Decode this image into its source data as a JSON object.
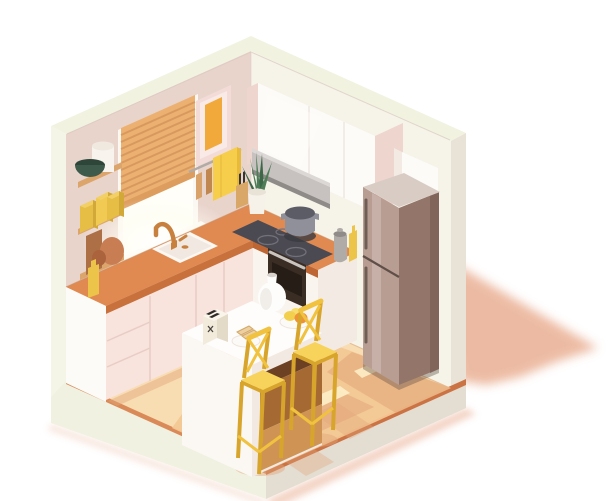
{
  "scene": {
    "label": "Isometric low-poly kitchen interior cutaway illustration",
    "background": "#ffffff",
    "objects": [
      "room-shell",
      "left-wall",
      "right-wall",
      "floor",
      "window",
      "venetian-blinds",
      "picture-frame",
      "utensil-rail",
      "towel",
      "wall-shelves",
      "green-bowl",
      "canister",
      "yellow-boxes",
      "cutting-boards",
      "yellow-bottle",
      "l-shaped-counter",
      "pink-cabinets",
      "sink",
      "copper-faucet",
      "induction-hob",
      "cooking-pot",
      "range-hood",
      "upper-cabinets",
      "oven",
      "pepper-grinder",
      "oil-bottle",
      "potted-plant",
      "knife-block",
      "refrigerator",
      "kitchen-island",
      "toaster",
      "toast-plate",
      "white-vase",
      "fruit-plate",
      "bar-stool-left",
      "bar-stool-right",
      "floor-shadows",
      "drop-shadow"
    ]
  },
  "palette": {
    "wall_top": "#f1f3e0",
    "wall_cut_left": "#f4f5e6",
    "wall_cut_right": "#e8e2d7",
    "plinth_left": "#f0f1e1",
    "plinth_right": "#e3ddd2",
    "floor_edge": "#d98a58",
    "floor_edge_dark": "#cb7344",
    "wall_pink": "#e9d4cc",
    "wall_cream": "#f6f3e8",
    "floor_light": "#f8dcb2",
    "floor_mid": "#f2c795",
    "floor_shadow": "#e2a478",
    "floor_patch": "#fdedc6",
    "drop_shadow": "#e8aa8c",
    "crease_wall": "#d9c8bf",
    "crease_floor": "#d8a97e",
    "counter_crease": "#c98c5e",
    "window_frame": "#fbf7f2",
    "window_glow": "#fffef8",
    "blind": "#ecb170",
    "blind_slat": "#d2925a",
    "blind_dark": "#dd9d5e",
    "frame_pink": "#f3dcd7",
    "frame_mat": "#f9eae7",
    "frame_art": "#f1a93c",
    "metal": "#b0aba7",
    "metal_light": "#cac4bf",
    "wood": "#d8a268",
    "wood_dark": "#c08850",
    "towel_yellow": "#f6ce4c",
    "towel_side": "#e8ba3c",
    "shelf_wood": "#dca56c",
    "white_obj": "#f8f4ed",
    "white_obj_top": "#efe9e0",
    "bowl_green": "#3e5a4a",
    "bowl_green_rim": "#2e463a",
    "box_y1": "#e6bd45",
    "box_y1_top": "#f3d065",
    "box_y1_side": "#d2a838",
    "box_y2": "#f0ca52",
    "board_brown": "#ad6f46",
    "board_terra": "#c87e52",
    "board_terra_dark": "#aa633d",
    "bottle_yellow": "#ecc44a",
    "counter_top": "#e08a52",
    "counter_edge": "#c9713c",
    "counter_edge_dark": "#bd6634",
    "cabinet_side": "#fdfbf7",
    "cabinet_pink": "#f8e3dd",
    "cabinet_seam": "#e8cdc4",
    "cabinet_white": "#faf4ee",
    "cabinet_white_side": "#f3ebe3",
    "cabinet_gloss": "#fcfbf7",
    "cabinet_pink_side": "#eed5cd",
    "cabinet_seam_light": "#eee8e0",
    "sink_white": "#fbf7f2",
    "sink_inner": "#f1e9e1",
    "faucet_copper": "#c8803f",
    "hob_dark": "#4b4a52",
    "hob_ring": "#72717b",
    "pot_gray": "#8f9099",
    "pot_dark": "#5c5c66",
    "pot_shadow": "#3a3941",
    "hood_metal": "#c7c2bf",
    "hood_light": "#dcd8d5",
    "hood_dark": "#8f8b89",
    "oven_dark": "#3a2d24",
    "oven_glass": "#251c15",
    "fridge_top": "#d8ccc4",
    "fridge_front": "#b89d93",
    "fridge_side": "#937669",
    "fridge_side_dark": "#7d6156",
    "fridge_line": "#5f4f47",
    "fridge_handle": "#6f5e55",
    "island_top": "#fefdfb",
    "island_left": "#fbf8f4",
    "island_right": "#f2eae2",
    "recess_dark": "#6b4023",
    "recess_mid": "#a56a33",
    "recess_light": "#cf9454",
    "toaster_cream": "#f2ebdc",
    "toaster_side": "#e3dac8",
    "toaster_top": "#faf5ea",
    "toaster_slot": "#2e2a26",
    "toaster_logo": "#4a443e",
    "plate_white": "#fcfaf7",
    "plate_rim": "#eee5dd",
    "toast": "#ecd0a0",
    "toast_crust": "#d3a766",
    "vase_white": "#fdfdfc",
    "vase_shade": "#e9e4de",
    "vase_mouth": "#d8d2cc",
    "lemon": "#f2cf4d",
    "lemon_light": "#f6dd6e",
    "orange_fruit": "#ef9338",
    "stool_yellow": "#f0c23f",
    "stool_dark": "#d8a52c",
    "stool_light": "#f7d35c",
    "plant_pot": "#f6f2ea",
    "plant_pot_rim": "#e9e2d7",
    "leaf_green": "#4e7d57",
    "leaf_dark": "#3c6847",
    "knife_block": "#d9a868",
    "knife_dark": "#3a3430",
    "highlight_white": "#ffffff"
  }
}
